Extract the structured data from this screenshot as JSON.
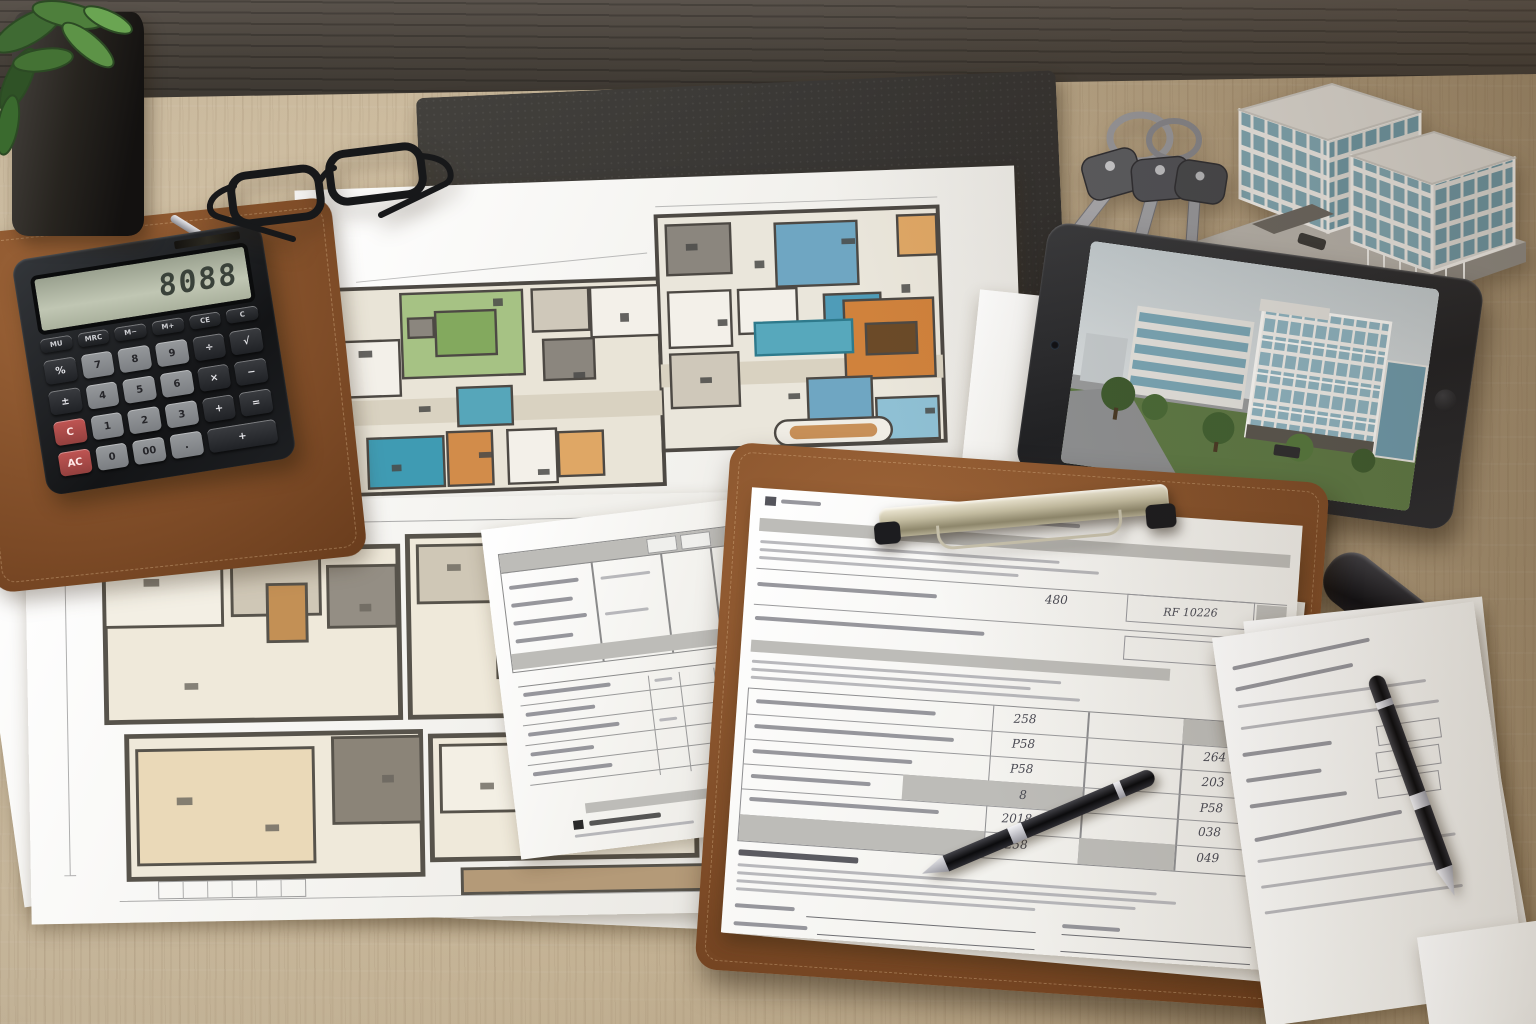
{
  "scene": {
    "title": "Architect's desk with floor plans, calculator, tablet and building model",
    "surface": "light oak desk with dark wood back edge"
  },
  "palette": {
    "desk_wood": "#d3bf9d",
    "desk_edge_dark": "#49423b",
    "desk_pad": "#3a3835",
    "leather_brown": "#7c4a26",
    "paper_white": "#f6f5f1",
    "plan_wall": "#4d4944",
    "plan_green": "#a6c284",
    "plan_teal": "#4f9cb8",
    "plan_orange": "#d0823c",
    "plan_beige": "#e9e4d7",
    "metal_clip": "#b9b29b",
    "tablet_body": "#2a2b2e",
    "model_glass": "#7fa6b2"
  },
  "calculator": {
    "display": "8088",
    "top_keys": [
      "MU",
      "MRC",
      "M−",
      "M+",
      "CE",
      "C"
    ],
    "key_rows": [
      [
        {
          "t": "%",
          "k": "fn"
        },
        {
          "t": "7"
        },
        {
          "t": "8"
        },
        {
          "t": "9"
        },
        {
          "t": "÷",
          "k": "op"
        },
        {
          "t": "√",
          "k": "op"
        }
      ],
      [
        {
          "t": "±",
          "k": "fn"
        },
        {
          "t": "4"
        },
        {
          "t": "5"
        },
        {
          "t": "6"
        },
        {
          "t": "×",
          "k": "op"
        },
        {
          "t": "−",
          "k": "op"
        }
      ],
      [
        {
          "t": "C",
          "k": "red"
        },
        {
          "t": "1"
        },
        {
          "t": "2"
        },
        {
          "t": "3"
        },
        {
          "t": "+",
          "k": "op"
        },
        {
          "t": "=",
          "k": "op"
        }
      ],
      [
        {
          "t": "AC",
          "k": "red"
        },
        {
          "t": "0"
        },
        {
          "t": "00"
        },
        {
          "t": "."
        },
        {
          "t": "+",
          "k": "op",
          "span": 2
        }
      ]
    ]
  },
  "clipboard_form": {
    "header_value": "480",
    "ref_value": "RF 10226",
    "values": [
      "258",
      "P58",
      "P58",
      "8",
      "2018",
      "258",
      "264",
      "203",
      "P58",
      "038",
      "049"
    ]
  },
  "tablet": {
    "screen_subject": "3D exterior rendering of a modern glass office complex"
  },
  "model_building": {
    "description": "architectural scale model, two glass towers on grey plinth",
    "towers": 2
  },
  "keys": {
    "count": 3
  }
}
